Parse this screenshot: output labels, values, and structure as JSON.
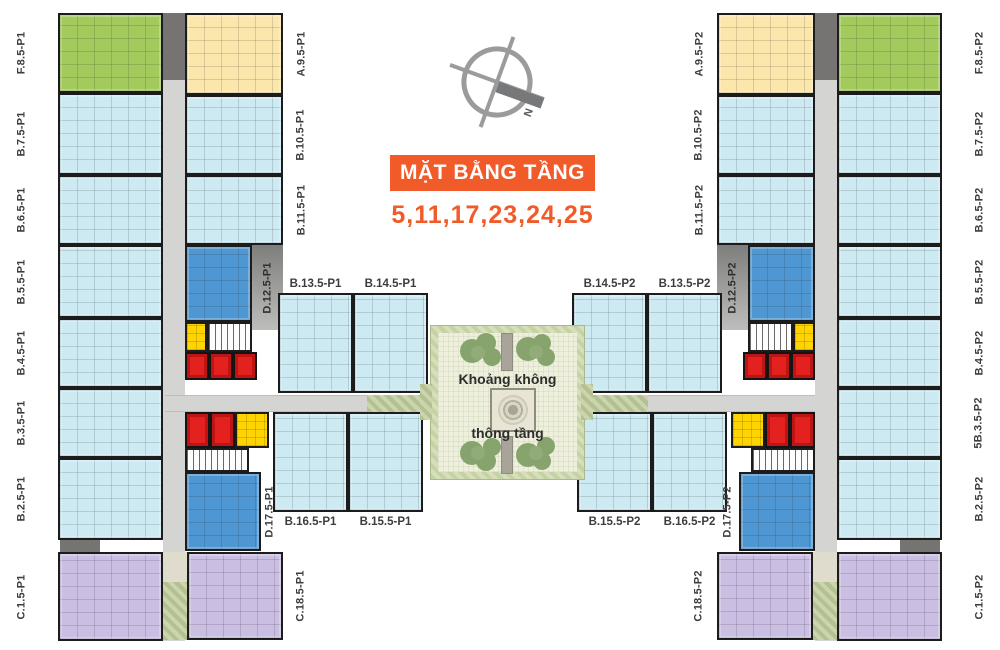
{
  "title": {
    "heading": "MẶT BẰNG TẦNG",
    "floors": "5,11,17,23,24,25"
  },
  "compass": {
    "north_label": "N"
  },
  "courtyard": {
    "label_line1": "Khoảng không",
    "label_line2": "thông tầng"
  },
  "left_wing": {
    "outer_labels": [
      "F.8.5-P1",
      "B.7.5-P1",
      "B.6.5-P1",
      "B.5.5-P1",
      "B.4.5-P1",
      "B.3.5-P1",
      "B.2.5-P1",
      "C.1.5-P1"
    ],
    "inner_labels": [
      "A.9.5-P1",
      "B.10.5-P1",
      "B.11.5-P1",
      "D.12.5-P1",
      "D.17.5-P1",
      "C.18.5-P1"
    ],
    "cluster_top_labels": [
      "B.13.5-P1",
      "B.14.5-P1"
    ],
    "cluster_bottom_labels": [
      "B.16.5-P1",
      "B.15.5-P1"
    ]
  },
  "right_wing": {
    "outer_labels": [
      "F.8.5-P2",
      "B.7.5-P2",
      "B.6.5-P2",
      "B.5.5-P2",
      "B.4.5-P2",
      "5B.3.5-P2",
      "B.2.5-P2",
      "C.1.5-P2"
    ],
    "inner_labels": [
      "A.9.5-P2",
      "B.10.5-P2",
      "B.11.5-P2",
      "D.12.5-P2",
      "D.17.5-P2",
      "C.18.5-P2"
    ],
    "cluster_top_labels": [
      "B.14.5-P2",
      "B.13.5-P2"
    ],
    "cluster_bottom_labels": [
      "B.15.5-P2",
      "B.16.5-P2"
    ]
  },
  "colors": {
    "blue": "#cdeaf3",
    "blue2": "#4f97d2",
    "green": "#a3ca5d",
    "cream": "#fbe6ab",
    "yellow": "#ffd400",
    "red": "#e3211f",
    "purple": "#cabfe2",
    "wall": "#1c1c1c",
    "corridor": "#d4d4d2",
    "graydark": "#757472",
    "olive": "#b4bf93",
    "courtbg": "#eef0dd",
    "orange": "#f15a29",
    "label": "#3d3d3d",
    "compass": "#9b9b9b"
  }
}
